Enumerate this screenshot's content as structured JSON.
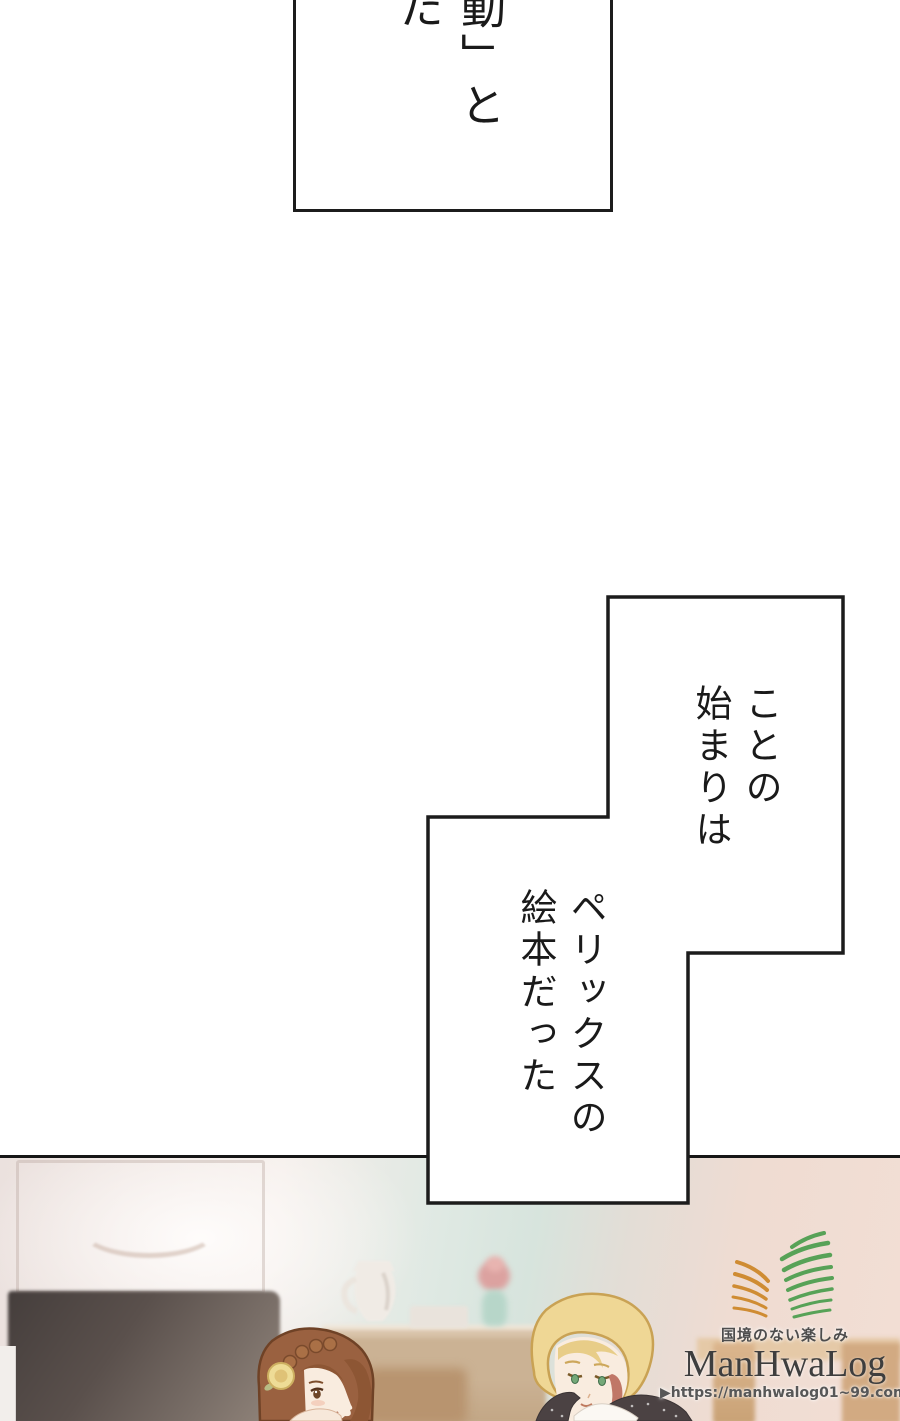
{
  "page": {
    "kind": "webtoon-manga-page",
    "background": "#ffffff",
    "panel_border_color": "#1c1c1c"
  },
  "dialogue": {
    "box1_text": "動」と\nた",
    "box2_text_upper": "ことの\n始まりは",
    "box2_text_lower": "ペリックスの\n絵本だった"
  },
  "watermark": {
    "tagline": "国境のない楽しみ",
    "brand": "ManHwaLog",
    "url": "▶https://manhwalog01~99.com◀",
    "logo_green": "#57a257",
    "logo_orange": "#cf8c33",
    "text_color": "#3e3e3e"
  },
  "scene": {
    "wall_pink": "#f0e6e2",
    "wall_teal": "#d9e6df",
    "wall_right_pink": "#f1ded4",
    "dark_furniture": "#554b48",
    "wood": "#d9b893",
    "woman_hair": "#9a6140",
    "man_hair": "#efd795",
    "skin": "#f9ecdf",
    "rose": "#eedc96"
  }
}
